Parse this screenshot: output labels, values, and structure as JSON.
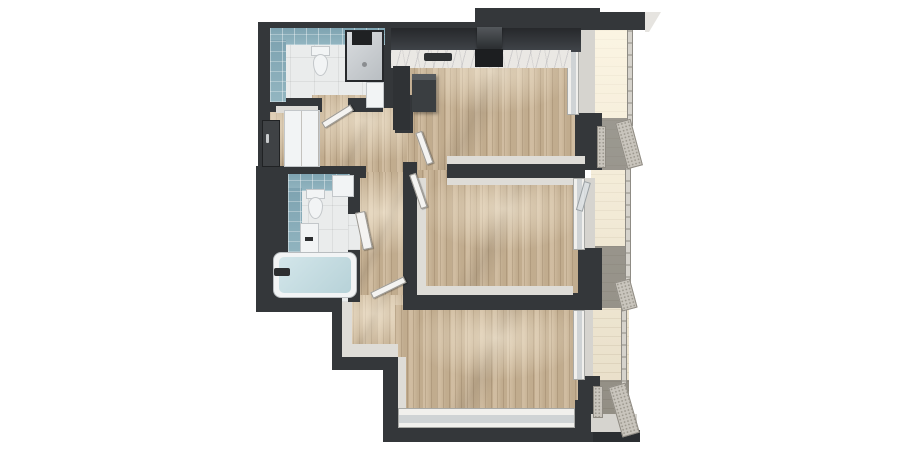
{
  "scene": {
    "kind": "3d-top-down-floor-plan-render",
    "background": "#ffffff",
    "units": "none",
    "text_visible": false
  },
  "palette": {
    "wall": "#34373a",
    "wall_deep": "#2b2e31",
    "wood": "#cbb596",
    "tile_floor": "#eaecec",
    "tile_blue_a": "#7ea3b1",
    "tile_blue_b": "#93b6c1",
    "marble": "#eae8e4",
    "cabinet": "#26282b",
    "cabinet_mid": "#3a3e41",
    "fixture": "#f2f4f5",
    "fixture_edge": "#c3c7ca",
    "water_a": "#d3e6ea",
    "water_b": "#b7d2d8",
    "face": "#dedcd7",
    "face2": "#d6d4cf",
    "window_frame": "#f1f0ed",
    "glass": "#cfd3d5",
    "balcony_floor": "#f4ead3",
    "rail_a": "#b3b0a8",
    "rail_b": "#d6d3cc",
    "mesh": "#c9c5bd",
    "mesh_dot": "#9d998f",
    "door_dark": "#3f4245",
    "roof": "#e6e4e0",
    "shower_a": "#d9dcdf",
    "shower_b": "#b9bec2"
  },
  "rooms": [
    {
      "id": "bathroom-top",
      "fixtures": [
        "toilet",
        "walk-in-shower",
        "washbasin-cabinet"
      ],
      "finishes": [
        "blue-wall-tile",
        "white-floor-tile"
      ]
    },
    {
      "id": "kitchen-living",
      "fixtures": [
        "upper-cabinet-run",
        "marble-counter",
        "kitchen-sink",
        "cooktop",
        "range-hood",
        "tall-dark-cabinet",
        "island-unit"
      ],
      "finishes": [
        "wood-plank-floor"
      ]
    },
    {
      "id": "entry-hall",
      "fixtures": [
        "entrance-door",
        "wardrobe"
      ],
      "finishes": [
        "wood-plank-floor"
      ]
    },
    {
      "id": "bathroom-bottom",
      "fixtures": [
        "toilet",
        "storage-box",
        "washbasin-vanity",
        "bathtub"
      ],
      "finishes": [
        "blue-wall-tile",
        "white-floor-tile"
      ]
    },
    {
      "id": "bedroom-middle",
      "fixtures": [
        "balcony-door"
      ],
      "finishes": [
        "wood-plank-floor"
      ]
    },
    {
      "id": "bedroom-bottom",
      "fixtures": [
        "low-window-band"
      ],
      "finishes": [
        "wood-plank-floor"
      ]
    },
    {
      "id": "hallway",
      "fixtures": [
        "interior-door-bathroom-top",
        "interior-door-bathroom-bottom",
        "interior-door-kitchen",
        "interior-door-bedroom-middle",
        "interior-door-bedroom-bottom"
      ],
      "finishes": [
        "wood-plank-floor"
      ]
    },
    {
      "id": "balcony-strip",
      "sections": 3,
      "fixtures": [
        "glass-railing",
        "mesh-privacy-screens",
        "divider-walls"
      ],
      "finishes": [
        "cream-decking"
      ]
    }
  ]
}
